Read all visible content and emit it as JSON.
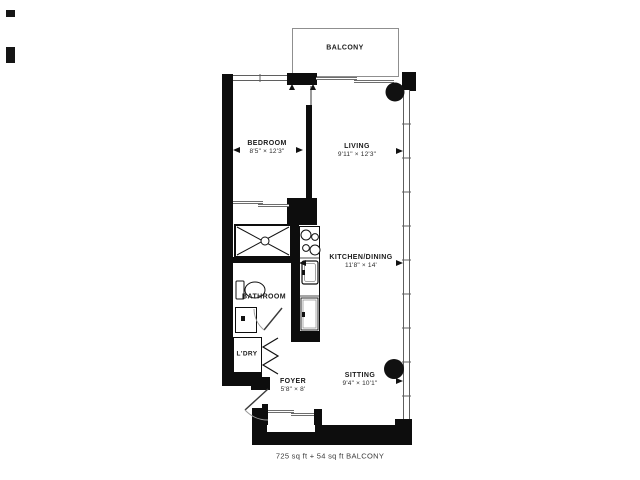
{
  "palette": {
    "wall": "#0d0d0d",
    "thin_line": "#8a8a8a",
    "text": "#1a1a1a",
    "fixture": "#1a1a1a"
  },
  "rooms": {
    "balcony": {
      "name": "BALCONY",
      "dims": ""
    },
    "bedroom": {
      "name": "BEDROOM",
      "dims": "8'5\" × 12'3\""
    },
    "living": {
      "name": "LIVING",
      "dims": "9'11\" × 12'3\""
    },
    "kitchen_dining": {
      "name": "KITCHEN/DINING",
      "dims": "11'8\" × 14'"
    },
    "bathroom": {
      "name": "BATHROOM",
      "dims": ""
    },
    "laundry": {
      "name": "L'DRY",
      "dims": ""
    },
    "foyer": {
      "name": "FOYER",
      "dims": "5'8\" × 8'"
    },
    "sitting": {
      "name": "SITTING",
      "dims": "9'4\" × 10'1\""
    }
  },
  "footer": {
    "area_note": "725 sq ft + 54 sq ft BALCONY"
  }
}
